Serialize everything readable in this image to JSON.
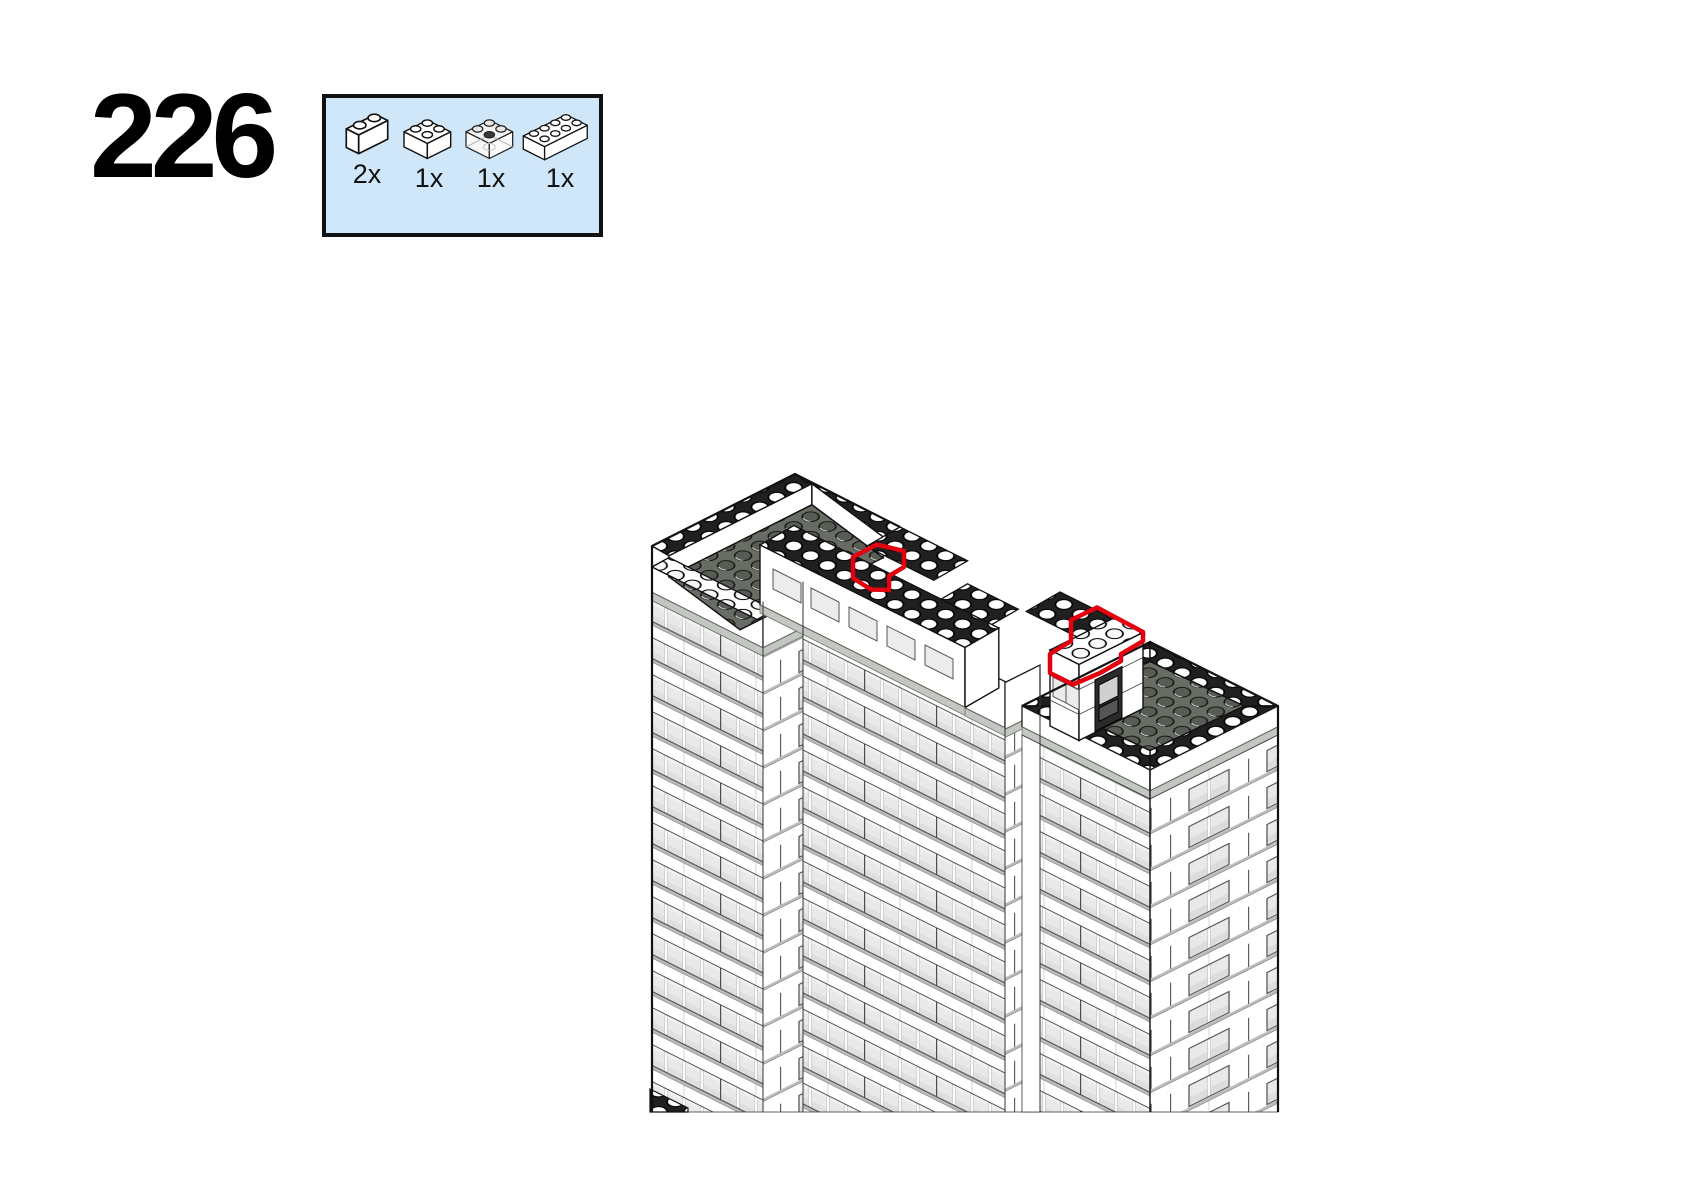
{
  "page": {
    "type": "lego-instruction-step-page"
  },
  "step": {
    "number": "226"
  },
  "parts_box": {
    "background": "#cfe7f8",
    "border_color": "#111111",
    "parts": [
      {
        "count": "2x",
        "name": "brick-1x2-white"
      },
      {
        "count": "1x",
        "name": "brick-2x2-white"
      },
      {
        "count": "1x",
        "name": "brick-2x2-trans-clear"
      },
      {
        "count": "1x",
        "name": "brick-2x4-white"
      }
    ]
  },
  "figure": {
    "name": "isometric-building-top",
    "highlight_color": "#e3000f",
    "roof_color": "#676c64",
    "ledge_color": "#b9beb9",
    "placements": [
      {
        "name": "brick-notch-on-parapet-wall"
      },
      {
        "name": "brick-group-on-penthouse-roof"
      }
    ]
  }
}
